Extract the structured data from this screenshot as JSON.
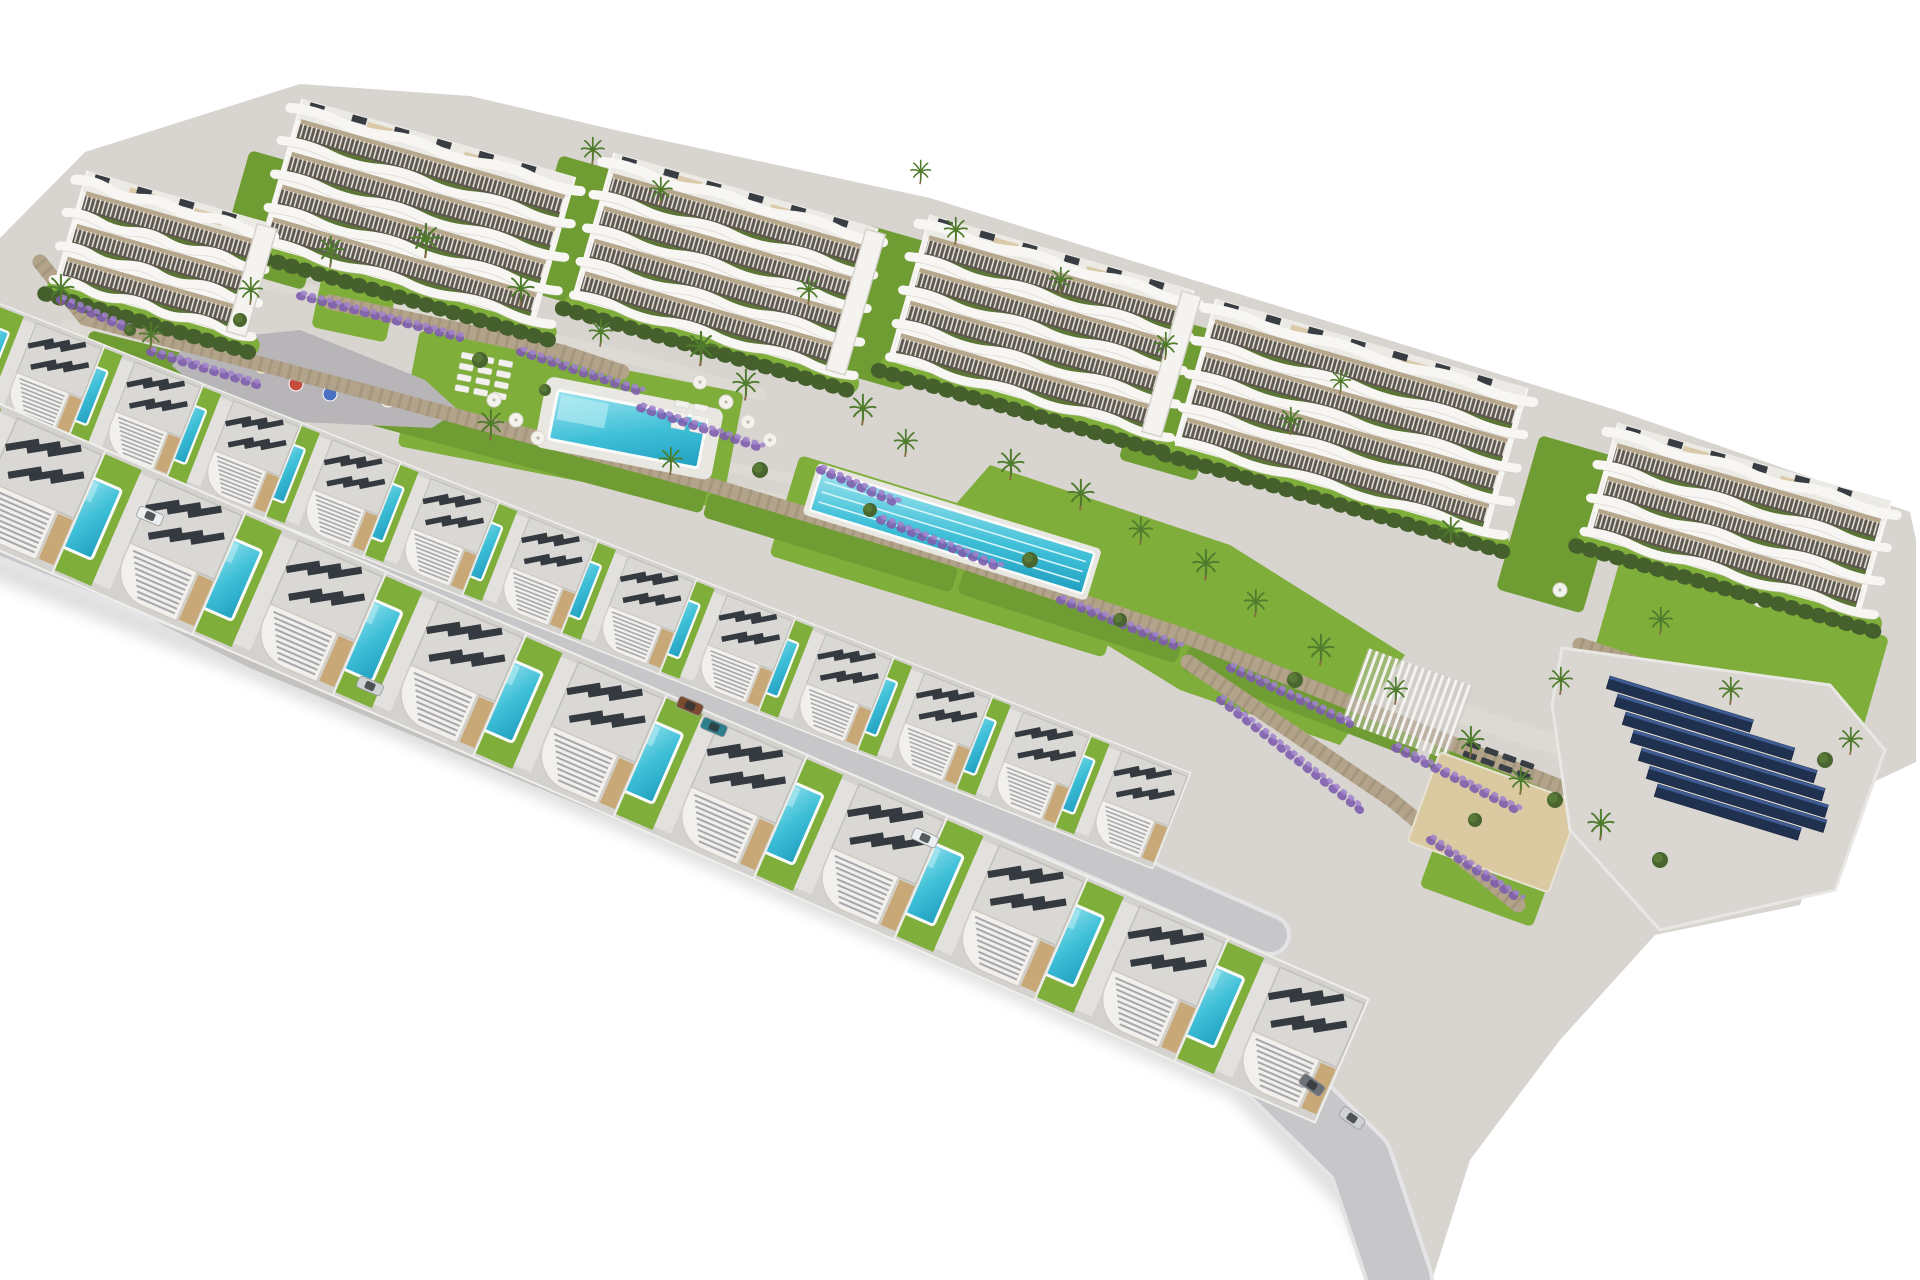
{
  "image": {
    "kind": "3d-architectural-aerial-render",
    "description": "Aerial 3D render of a hillside residential development: six curved white apartment blocks with terraced balconies at the top, communal gardens with a main swimming pool, a long lap pool, playground, pergola, sunbathing deck and a solar-panel array in the middle, and two staggered rows of modern white villas, each with a private turquoise pool, in the foreground. Pure white background.",
    "background": "#ffffff"
  },
  "palette": {
    "land": "#d8d5d0",
    "path": "#ddd9d3",
    "road": "#c7c6c9",
    "road_casing": "#e4e3e5",
    "shadow": "#8d8d93",
    "building_white": "#f7f6f3",
    "building_shade": "#c9c5be",
    "interior_dark": "#5d574e",
    "interior_beige": "#cdbb9e",
    "railing": "#edebe7",
    "roof_deck": "#eceae5",
    "roof_beige": "#d8c7a2",
    "ac_dark": "#383d43",
    "tower_white": "#f4f3ef",
    "hedge": "#45602c",
    "lawn": "#6f9c33",
    "lawn_bright": "#7fae3a",
    "planter": "#5a7a33",
    "stone": "#b2a38a",
    "stone_joint": "#8e8166",
    "water_light": "#9fe4ee",
    "water_mid": "#3fc0d8",
    "water_deep": "#209fc0",
    "coping": "#fbfbfa",
    "lane": "#dff7fb",
    "solar_panel": "#20304f",
    "solar_sheen": "#3e5b94",
    "solar_pad": "#dad7d2",
    "sand": "#dbc9a2",
    "purple": "#7f5fae",
    "purple_light": "#a184cc",
    "palm": "#4f7c2d",
    "trunk": "#8a6a44",
    "bush": "#4a6630",
    "playground": "#b7b5b7",
    "villa_plot": "#d4d2ce",
    "villa_terrace": "#e3e1dd",
    "villa_roof": "#d9d8d4",
    "villa_roof_edge": "#c2c0bb",
    "villa_louver": "#a9a7ab",
    "villa_beige": "#c8a877",
    "villa_solar": "#343a40",
    "lounger_white": "#f2f1ee",
    "lounger_dark": "#3a3f45"
  },
  "land": {
    "outline": [
      [
        0,
        238
      ],
      [
        85,
        152
      ],
      [
        300,
        84
      ],
      [
        470,
        96
      ],
      [
        615,
        130
      ],
      [
        930,
        198
      ],
      [
        1213,
        286
      ],
      [
        1616,
        410
      ],
      [
        1910,
        512
      ],
      [
        1916,
        540
      ],
      [
        1916,
        762
      ],
      [
        1835,
        800
      ],
      [
        1800,
        905
      ],
      [
        1655,
        935
      ],
      [
        1560,
        1040
      ],
      [
        1470,
        1160
      ],
      [
        1432,
        1280
      ],
      [
        1400,
        1280
      ],
      [
        1360,
        1205
      ],
      [
        1240,
        1088
      ],
      [
        1000,
        984
      ],
      [
        650,
        834
      ],
      [
        250,
        668
      ],
      [
        0,
        545
      ]
    ]
  },
  "paths": [
    {
      "pts": [
        [
          70,
          330
        ],
        [
          420,
          430
        ],
        [
          760,
          500
        ],
        [
          1000,
          560
        ],
        [
          1240,
          640
        ],
        [
          1540,
          740
        ],
        [
          1800,
          820
        ]
      ],
      "w": 20
    },
    {
      "pts": [
        [
          90,
          255
        ],
        [
          400,
          305
        ],
        [
          640,
          360
        ],
        [
          760,
          395
        ]
      ],
      "w": 12
    },
    {
      "pts": [
        [
          640,
          440
        ],
        [
          700,
          462
        ],
        [
          790,
          478
        ]
      ],
      "w": 10
    }
  ],
  "roads": [
    {
      "pts": [
        [
          -60,
          405
        ],
        [
          250,
          515
        ],
        [
          650,
          672
        ],
        [
          1050,
          838
        ],
        [
          1270,
          935
        ]
      ],
      "w": 34
    },
    {
      "pts": [
        [
          -60,
          500
        ],
        [
          250,
          622
        ],
        [
          650,
          788
        ],
        [
          1000,
          938
        ],
        [
          1240,
          1042
        ],
        [
          1360,
          1160
        ],
        [
          1400,
          1280
        ]
      ],
      "w": 60
    }
  ],
  "shadow_edge": {
    "pts": [
      [
        -60,
        545
      ],
      [
        250,
        665
      ],
      [
        650,
        830
      ],
      [
        1000,
        980
      ],
      [
        1238,
        1086
      ],
      [
        1352,
        1202
      ],
      [
        1390,
        1280
      ]
    ],
    "w": 26
  },
  "lawns": [
    {
      "type": "rect",
      "x": 420,
      "y": 330,
      "w": 330,
      "h": 118,
      "rot": 11,
      "tone": "bright"
    },
    {
      "type": "rect",
      "x": 800,
      "y": 455,
      "w": 350,
      "h": 105,
      "rot": 17,
      "tone": "bright"
    },
    {
      "type": "poly",
      "tone": "bright",
      "pts": [
        [
          990,
          465
        ],
        [
          1230,
          545
        ],
        [
          1405,
          655
        ],
        [
          1340,
          745
        ],
        [
          1180,
          690
        ],
        [
          1010,
          585
        ],
        [
          955,
          505
        ]
      ]
    },
    {
      "type": "rect",
      "x": 322,
      "y": 276,
      "w": 76,
      "h": 52,
      "rot": 12,
      "tone": "bright"
    },
    {
      "type": "rect",
      "x": 90,
      "y": 330,
      "w": 290,
      "h": 26,
      "rot": 14,
      "tone": "dark"
    },
    {
      "type": "rect",
      "x": 370,
      "y": 398,
      "w": 350,
      "h": 26,
      "rot": 15,
      "tone": "dark"
    },
    {
      "type": "rect",
      "x": 710,
      "y": 492,
      "w": 260,
      "h": 26,
      "rot": 17,
      "tone": "dark"
    },
    {
      "type": "rect",
      "x": 965,
      "y": 568,
      "w": 230,
      "h": 26,
      "rot": 18,
      "tone": "dark"
    },
    {
      "type": "rect",
      "x": 1190,
      "y": 645,
      "w": 250,
      "h": 26,
      "rot": 21,
      "tone": "dark"
    },
    {
      "type": "rect",
      "x": 1435,
      "y": 742,
      "w": 180,
      "h": 26,
      "rot": 21,
      "tone": "dark"
    },
    {
      "type": "rect",
      "x": 250,
      "y": 150,
      "w": 90,
      "h": 120,
      "rot": 16,
      "tone": "dark"
    },
    {
      "type": "rect",
      "x": 560,
      "y": 155,
      "w": 80,
      "h": 140,
      "rot": 16,
      "tone": "dark"
    },
    {
      "type": "rect",
      "x": 868,
      "y": 225,
      "w": 80,
      "h": 150,
      "rot": 16,
      "tone": "dark"
    },
    {
      "type": "rect",
      "x": 1160,
      "y": 315,
      "w": 80,
      "h": 150,
      "rot": 16,
      "tone": "dark"
    },
    {
      "type": "rect",
      "x": 1540,
      "y": 435,
      "w": 90,
      "h": 160,
      "rot": 16,
      "tone": "dark"
    },
    {
      "type": "rect",
      "x": 1620,
      "y": 560,
      "w": 280,
      "h": 110,
      "rot": 16,
      "tone": "bright"
    },
    {
      "type": "rect",
      "x": 1440,
      "y": 830,
      "w": 120,
      "h": 60,
      "rot": 20,
      "tone": "bright"
    }
  ],
  "walls": [
    [
      85,
      318,
      360,
      390
    ],
    [
      360,
      390,
      700,
      482
    ],
    [
      700,
      482,
      958,
      560
    ],
    [
      958,
      560,
      1185,
      636
    ],
    [
      1185,
      636,
      1428,
      734
    ],
    [
      1428,
      734,
      1608,
      806
    ],
    [
      1188,
      662,
      1392,
      800
    ],
    [
      1392,
      800,
      1518,
      905
    ],
    [
      330,
      302,
      562,
      352
    ],
    [
      562,
      352,
      622,
      372
    ],
    [
      40,
      262,
      85,
      318
    ],
    [
      1580,
      645,
      1835,
      730
    ]
  ],
  "flowers": [
    [
      300,
      296,
      460,
      338
    ],
    [
      520,
      352,
      640,
      392
    ],
    [
      640,
      408,
      760,
      448
    ],
    [
      880,
      520,
      1000,
      568
    ],
    [
      1060,
      600,
      1180,
      648
    ],
    [
      1230,
      668,
      1350,
      724
    ],
    [
      1395,
      748,
      1520,
      812
    ],
    [
      1220,
      700,
      1360,
      810
    ],
    [
      1430,
      840,
      1520,
      900
    ],
    [
      150,
      352,
      260,
      386
    ],
    [
      60,
      300,
      130,
      330
    ],
    [
      820,
      470,
      900,
      505
    ]
  ],
  "playground": {
    "outline": [
      [
        185,
        342
      ],
      [
        300,
        330
      ],
      [
        425,
        380
      ],
      [
        458,
        410
      ],
      [
        432,
        428
      ],
      [
        300,
        422
      ],
      [
        205,
        394
      ],
      [
        172,
        366
      ]
    ],
    "items": [
      {
        "x": 262,
        "y": 366,
        "c": "#e8c93e"
      },
      {
        "x": 296,
        "y": 384,
        "c": "#c84b3f"
      },
      {
        "x": 330,
        "y": 394,
        "c": "#4a6fc0"
      },
      {
        "x": 388,
        "y": 400,
        "c": "#d9c9a4"
      }
    ]
  },
  "pools": {
    "main": {
      "x": 558,
      "y": 390,
      "w": 152,
      "h": 50,
      "rot": 11
    },
    "main_deck": {
      "x": 545,
      "y": 378,
      "w": 180,
      "h": 72,
      "rot": 11
    },
    "lap": {
      "x": 822,
      "y": 470,
      "w": 285,
      "h": 42,
      "rot": 17,
      "lanes": 3
    }
  },
  "lounger_clusters": [
    {
      "x": 462,
      "y": 352,
      "rows": 4,
      "cols": 3,
      "rot": 11,
      "dark": false
    },
    {
      "x": 676,
      "y": 400,
      "rows": 3,
      "cols": 2,
      "rot": 11,
      "dark": false
    },
    {
      "x": 1468,
      "y": 740,
      "rows": 2,
      "cols": 4,
      "rot": 20,
      "dark": true
    }
  ],
  "parasols": [
    [
      494,
      400
    ],
    [
      516,
      420
    ],
    [
      538,
      438
    ],
    [
      726,
      402
    ],
    [
      748,
      422
    ],
    [
      770,
      440
    ],
    [
      700,
      382
    ],
    [
      420,
      300
    ],
    [
      960,
      300
    ],
    [
      1105,
      356
    ],
    [
      1248,
      425
    ],
    [
      1430,
      520
    ],
    [
      1560,
      590
    ],
    [
      340,
      246
    ],
    [
      1700,
      560
    ],
    [
      1760,
      600
    ]
  ],
  "pergola": {
    "x": 1368,
    "y": 648,
    "w": 112,
    "h": 78,
    "rot": 20
  },
  "sand_court": {
    "x": 1440,
    "y": 752,
    "w": 150,
    "h": 95,
    "rot": 20
  },
  "solar": {
    "pad": [
      [
        1562,
        648
      ],
      [
        1830,
        685
      ],
      [
        1885,
        750
      ],
      [
        1835,
        890
      ],
      [
        1660,
        930
      ],
      [
        1570,
        830
      ],
      [
        1552,
        705
      ]
    ],
    "rot": 17,
    "panel_h": 13,
    "rows": [
      {
        "x": 1610,
        "y": 676,
        "len": 150
      },
      {
        "x": 1618,
        "y": 694,
        "len": 185
      },
      {
        "x": 1626,
        "y": 712,
        "len": 200
      },
      {
        "x": 1634,
        "y": 730,
        "len": 200
      },
      {
        "x": 1642,
        "y": 748,
        "len": 195
      },
      {
        "x": 1650,
        "y": 766,
        "len": 185
      },
      {
        "x": 1658,
        "y": 784,
        "len": 150
      }
    ]
  },
  "apartments": {
    "rot": 16,
    "floor_h": 34,
    "blocks": [
      {
        "x": 85,
        "y": 168,
        "len": 195,
        "floors": 3,
        "tower": true
      },
      {
        "x": 300,
        "y": 96,
        "len": 290,
        "floors": 4,
        "tower": false
      },
      {
        "x": 612,
        "y": 150,
        "len": 280,
        "floors": 4,
        "tower": true
      },
      {
        "x": 928,
        "y": 212,
        "len": 280,
        "floors": 4,
        "tower": true
      },
      {
        "x": 1214,
        "y": 296,
        "len": 330,
        "floors": 4,
        "tower": false
      },
      {
        "x": 1616,
        "y": 420,
        "len": 290,
        "floors": 3,
        "tower": false
      }
    ]
  },
  "villas": {
    "plot": {
      "w": 172,
      "h": 132
    },
    "rows": [
      {
        "name": "upper",
        "x": -20,
        "y": 296,
        "rot": 21.5,
        "scale": 0.78,
        "count": 12,
        "step": 136
      },
      {
        "name": "front",
        "x": -55,
        "y": 380,
        "rot": 23.5,
        "scale": 1.02,
        "count": 10,
        "step": 150
      }
    ]
  },
  "cars": [
    {
      "x": 150,
      "y": 516,
      "rot": 23,
      "c": "#eceff0"
    },
    {
      "x": 370,
      "y": 686,
      "rot": 23,
      "c": "#cfd2d4"
    },
    {
      "x": 690,
      "y": 706,
      "rot": 23,
      "c": "#7a4b2e"
    },
    {
      "x": 714,
      "y": 727,
      "rot": 23,
      "c": "#2e7f8c"
    },
    {
      "x": 925,
      "y": 838,
      "rot": 24,
      "c": "#eceff0"
    },
    {
      "x": 1312,
      "y": 1085,
      "rot": 35,
      "c": "#6b7076"
    },
    {
      "x": 1352,
      "y": 1118,
      "rot": 35,
      "c": "#cfd2d4"
    }
  ],
  "palms": [
    [
      60,
      300,
      0.9
    ],
    [
      150,
      345,
      0.8
    ],
    [
      250,
      300,
      0.8
    ],
    [
      330,
      262,
      0.9
    ],
    [
      425,
      252,
      1
    ],
    [
      520,
      300,
      0.9
    ],
    [
      600,
      342,
      0.8
    ],
    [
      592,
      160,
      0.8
    ],
    [
      660,
      200,
      0.8
    ],
    [
      700,
      360,
      1
    ],
    [
      745,
      395,
      0.9
    ],
    [
      808,
      300,
      0.8
    ],
    [
      862,
      420,
      0.9
    ],
    [
      905,
      452,
      0.8
    ],
    [
      955,
      240,
      0.8
    ],
    [
      1010,
      475,
      0.9
    ],
    [
      1060,
      290,
      0.8
    ],
    [
      1080,
      505,
      0.9
    ],
    [
      1140,
      540,
      0.8
    ],
    [
      1165,
      355,
      0.8
    ],
    [
      1205,
      575,
      0.9
    ],
    [
      1255,
      612,
      0.8
    ],
    [
      1290,
      430,
      0.8
    ],
    [
      1320,
      660,
      0.9
    ],
    [
      1395,
      700,
      0.8
    ],
    [
      1450,
      540,
      0.8
    ],
    [
      1470,
      752,
      0.9
    ],
    [
      1520,
      790,
      0.8
    ],
    [
      1560,
      690,
      0.8
    ],
    [
      1600,
      835,
      0.9
    ],
    [
      1660,
      630,
      0.8
    ],
    [
      1730,
      700,
      0.8
    ],
    [
      920,
      180,
      0.7
    ],
    [
      1340,
      390,
      0.7
    ],
    [
      490,
      435,
      0.9
    ],
    [
      670,
      470,
      0.8
    ],
    [
      1850,
      750,
      0.8
    ]
  ],
  "bushes": [
    [
      240,
      320,
      7
    ],
    [
      480,
      360,
      8
    ],
    [
      760,
      470,
      8
    ],
    [
      1030,
      560,
      8
    ],
    [
      1295,
      680,
      8
    ],
    [
      1555,
      800,
      8
    ],
    [
      130,
      330,
      6
    ],
    [
      870,
      510,
      7
    ],
    [
      1660,
      860,
      8
    ],
    [
      1825,
      760,
      8
    ],
    [
      545,
      390,
      6
    ],
    [
      1120,
      620,
      7
    ],
    [
      1475,
      820,
      7
    ]
  ]
}
